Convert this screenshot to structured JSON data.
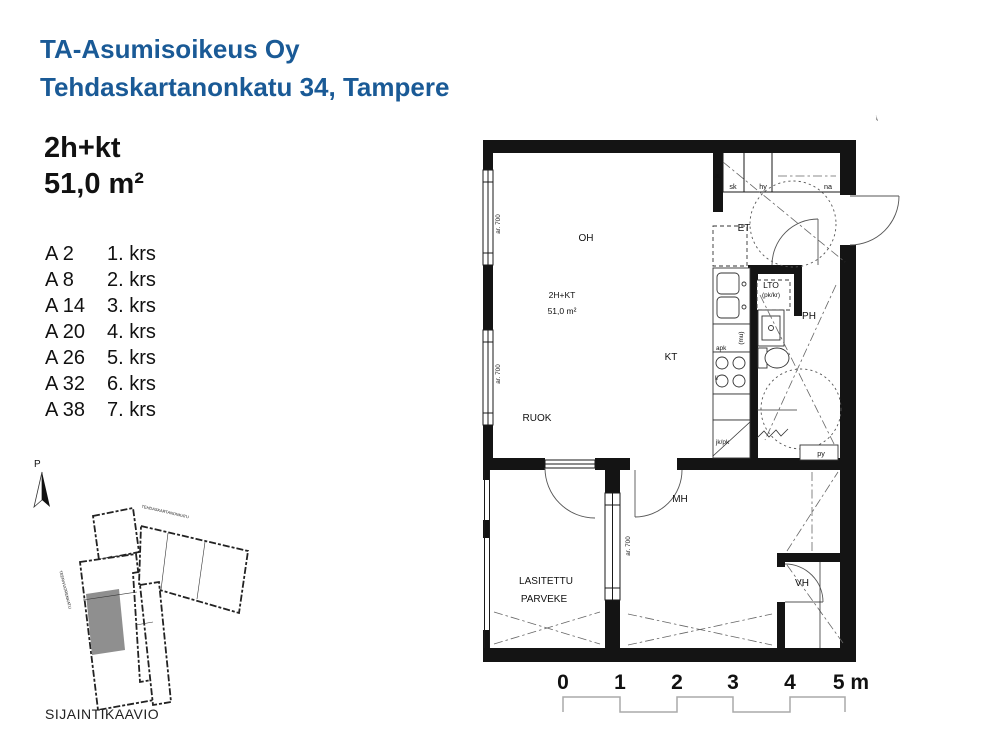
{
  "header": {
    "line1": "TA-Asumisoikeus Oy",
    "line2": "Tehdaskartanonkatu 34, Tampere"
  },
  "apartment": {
    "type": "2h+kt",
    "area": "51,0 m²"
  },
  "unit_list": [
    {
      "unit": "A 2",
      "floor": "1. krs"
    },
    {
      "unit": "A 8",
      "floor": "2. krs"
    },
    {
      "unit": "A 14",
      "floor": "3. krs"
    },
    {
      "unit": "A 20",
      "floor": "4. krs"
    },
    {
      "unit": "A 26",
      "floor": "5. krs"
    },
    {
      "unit": "A 32",
      "floor": "6. krs"
    },
    {
      "unit": "A 38",
      "floor": "7. krs"
    }
  ],
  "north": {
    "label": "P"
  },
  "floor_plan": {
    "rooms": {
      "oh": "OH",
      "kt": "KT",
      "ruok": "RUOK",
      "mh": "MH",
      "et": "ET",
      "ph": "PH",
      "vh": "VH",
      "lto": "LTO",
      "lto_sub": "(pk/kr)",
      "balcony1": "LASITETTU",
      "balcony2": "PARVEKE"
    },
    "area_label": {
      "line1": "2H+KT",
      "line2": "51,0 m²"
    },
    "closets": {
      "sk": "sk",
      "hy": "hy",
      "na": "na"
    },
    "kitchen": {
      "apk": "apk",
      "mu": "(mu)",
      "li": "li",
      "jkpk": "jk/pk",
      "jk": "jk"
    },
    "bath": {
      "py": "py"
    },
    "window_label": "ar. 700"
  },
  "scale_bar": {
    "ticks": [
      "0",
      "1",
      "2",
      "3",
      "4",
      "5 m"
    ]
  },
  "site_plan": {
    "north_label": "P",
    "street_top": "TEHDASKARTANONKATU",
    "street_left": "TEERIVUORENKATU",
    "caption": "SIJAINTIKAAVIO"
  },
  "colors": {
    "accent": "#1a5a96",
    "plan_line": "#1a1a1a",
    "highlight_gray": "#8f8f8f"
  }
}
